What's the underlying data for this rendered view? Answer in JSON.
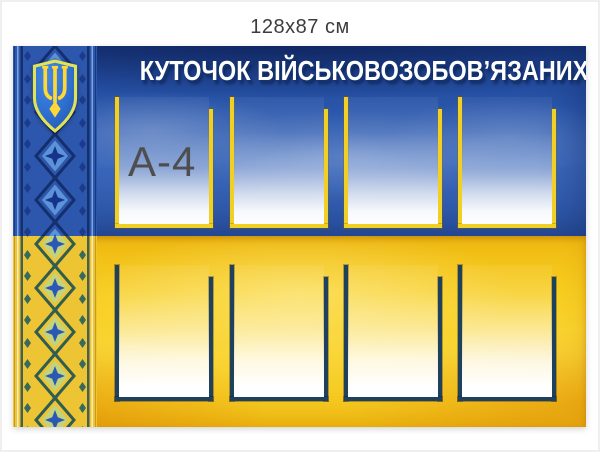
{
  "caption": "128x87 см",
  "board": {
    "title": "КУТОЧОК ВІЙСЬКОВОЗОБОВ’ЯЗАНИХ",
    "pocket_label": "A-4",
    "top_row_pockets": 4,
    "bottom_row_pockets": 4,
    "emblem_icon": "ukrainian-trident-shield",
    "ornament_icon": "vyshyvanka-embroidery-strip",
    "colors": {
      "flag_blue": "#2a57ac",
      "flag_blue_dark": "#1c3f8e",
      "flag_yellow": "#f7cd20",
      "flag_yellow_deep": "#efba12",
      "top_pocket_border": "#f0d024",
      "bottom_pocket_border": "#20415c",
      "title_text": "#ffffff",
      "title_shadow": "#12336e",
      "pocket_label_text": "#4e4e4e",
      "caption_text": "#3c3c3c",
      "trident_yellow": "#ffd838",
      "shield_blue": "#2e6fd0"
    }
  }
}
